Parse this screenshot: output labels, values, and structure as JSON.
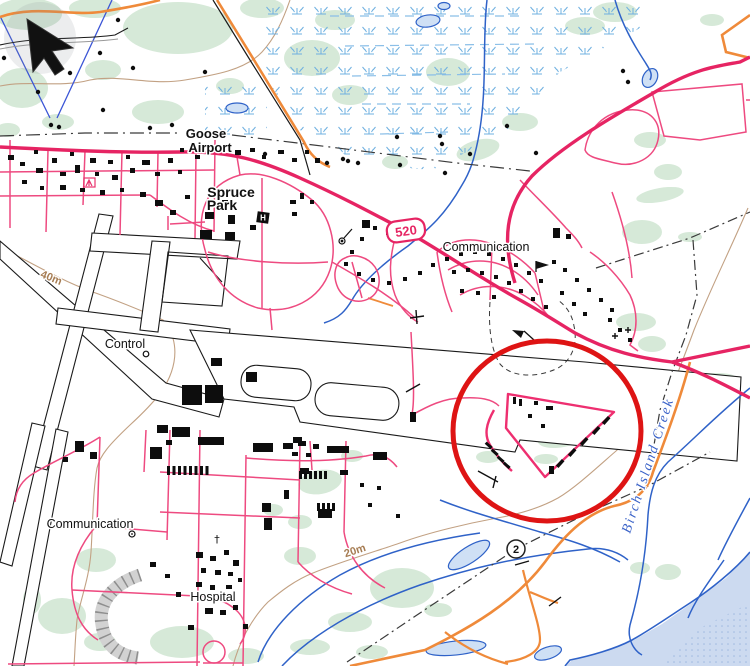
{
  "viewport": {
    "width": 750,
    "height": 666
  },
  "map": {
    "labels": {
      "goose_airport_line1": "Goose",
      "goose_airport_line2": "Airport",
      "spruce_park_line1": "Spruce",
      "spruce_park_line2": "Park",
      "communication_north": "Communication",
      "communication_south": "Communication",
      "control": "Control",
      "hospital": "Hospital",
      "creek": "Birch Island Creek",
      "contour_40": "40m",
      "contour_20": "20m",
      "church_symbol": "†",
      "helipad_symbol": "H"
    },
    "shields": {
      "route_520": "520",
      "trail_2": "2"
    },
    "colors": {
      "road_major": "#e62463",
      "road_minor": "#ee4a80",
      "road_orange": "#ef8a3a",
      "stream_blue": "#2f62c8",
      "water_fill": "#ccdaf0",
      "forest_green": "#d6e9d8",
      "contour_brown": "#c2a183",
      "marsh_blue": "#6fb0e0",
      "annotation_red": "#de1414",
      "building_black": "#0d0d0d"
    }
  },
  "annotation": {
    "shape": "red-circle"
  },
  "cursor": {
    "type": "arrow-pointer"
  }
}
